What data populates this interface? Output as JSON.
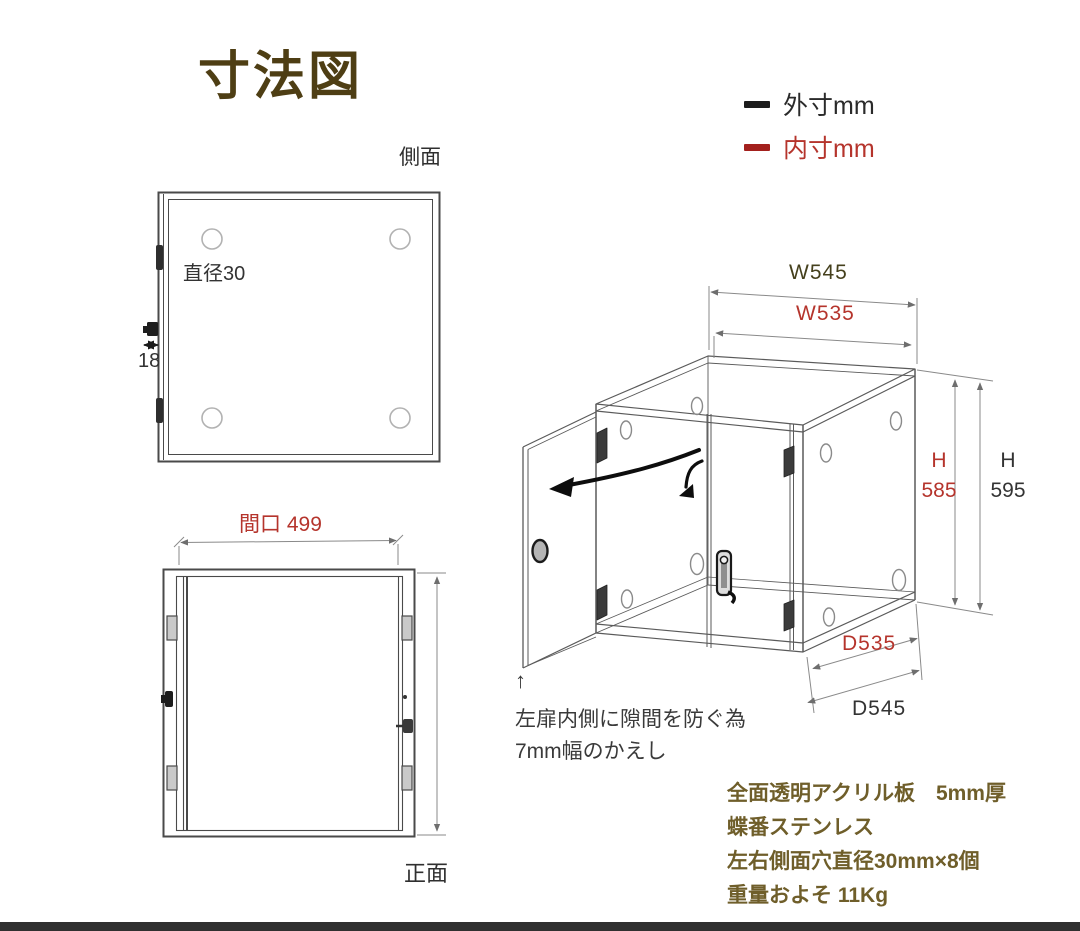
{
  "title": "寸法図",
  "legend": {
    "outer": {
      "label": "外寸mm",
      "color": "#1c1c1c"
    },
    "inner": {
      "label": "内寸mm",
      "color": "#a3201d"
    }
  },
  "side_view": {
    "label": "側面",
    "hole_note": "直径30",
    "thickness": "18"
  },
  "front_view": {
    "label": "正面",
    "opening": "間口 499"
  },
  "iso_view": {
    "w_outer": "W545",
    "w_inner": "W535",
    "h_inner": "H\n585",
    "h_outer": "H\n595",
    "d_inner": "D535",
    "d_outer": "D545",
    "note_arrow": "↑",
    "note_line1": "左扉内側に隙間を防ぐ為",
    "note_line2": "7mm幅のかえし"
  },
  "specs": {
    "line1": "全面透明アクリル板　5mm厚",
    "line2": "蝶番ステンレス",
    "line3": "左右側面穴直径30mm×8個",
    "line4": "重量およそ 11Kg"
  },
  "colors": {
    "title": "#4e3e14",
    "spec_text": "#6f5e2a",
    "inner_dim_red": "#b5342c",
    "outer_dim_black": "#333333",
    "line_gray": "#5a5a5a"
  }
}
